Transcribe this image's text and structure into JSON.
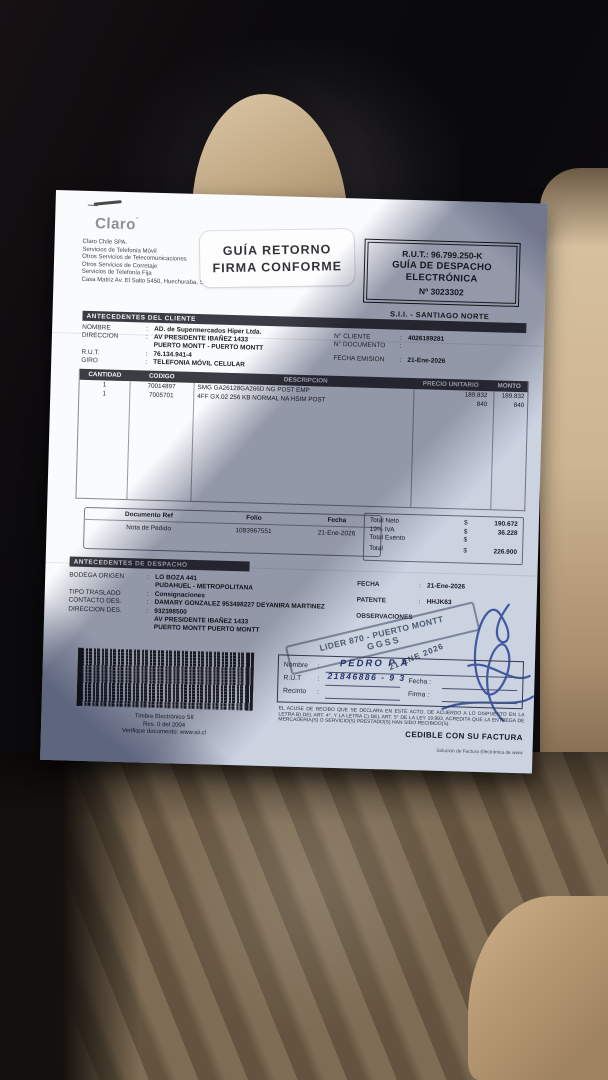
{
  "colors": {
    "section_bar": "#3c3c45",
    "stamp_ink": "#48546c",
    "pen_ink": "#2b3c7c",
    "paper": "#fafbfd"
  },
  "header": {
    "logo": "Claro",
    "company_lines": {
      "l0": "Claro Chile SPA.",
      "l1": "Servicios de Telefonía Móvil",
      "l2": "Otros Servicios de Telecomunicaciones",
      "l3": "Otros Servicios de Corretaje",
      "l4": "Servicios de Telefonía Fija",
      "l5": "Casa Matriz Av. El Salto 5450, Huechuraba, Sa"
    },
    "sticker": {
      "line1": "GUÍA RETORNO",
      "line2": "FIRMA CONFORME"
    },
    "rut_box": {
      "rut": "R.U.T.: 96.799.250-K",
      "doc_type_line1": "GUÍA DE DESPACHO",
      "doc_type_line2": "ELECTRÓNICA",
      "number": "Nº 3023302"
    },
    "sii_office": "S.I.I. - SANTIAGO NORTE"
  },
  "client": {
    "section_title": "ANTECEDENTES DEL CLIENTE",
    "fields": [
      {
        "label": "NOMBRE",
        "sep": ":",
        "value": "AD. de Supermercados Hiper Ltda."
      },
      {
        "label": "DIRECCION",
        "sep": ":",
        "value": "AV PRESIDENTE IBAÑEZ 1433"
      },
      {
        "label": "",
        "sep": "",
        "value": "PUERTO MONTT -  PUERTO MONTT"
      },
      {
        "label": "R.U.T.",
        "sep": ":",
        "value": "76.134.941-4"
      },
      {
        "label": "GIRO",
        "sep": ":",
        "value": "TELEFONIA MÓVIL CELULAR"
      }
    ],
    "right_fields": [
      {
        "label": "N° CLIENTE",
        "sep": ":",
        "value": "4026189281"
      },
      {
        "label": "N° DOCUMENTO",
        "sep": ":",
        "value": ""
      },
      {
        "label": "FECHA EMISION",
        "sep": ":",
        "value": "21-Ene-2026"
      }
    ]
  },
  "items": {
    "columns": [
      "CANTIDAD",
      "CODIGO",
      "DESCRIPCION",
      "PRECIO UNITARIO",
      "MONTO"
    ],
    "rows": [
      {
        "cantidad": "1",
        "codigo": "70014897",
        "descripcion": "SMG GA26128GA266D NG POST EMP",
        "precio": "189.832",
        "monto": "189.832"
      },
      {
        "cantidad": "1",
        "codigo": "7005701",
        "descripcion": "4FF GX.02 256 KB NORMAL NA HSIM POST",
        "precio": "840",
        "monto": "840"
      }
    ]
  },
  "ref_docs": {
    "columns": [
      "Documento Ref",
      "Folio",
      "Fecha"
    ],
    "row": {
      "doc": "Nota de Pedido",
      "folio": "1083967551",
      "fecha": "21-Ene-2026"
    }
  },
  "totals": {
    "rows": [
      {
        "label": "Total Neto",
        "currency": "$",
        "value": "190.672"
      },
      {
        "label": "19% IVA",
        "currency": "$",
        "value": "36.228"
      },
      {
        "label": "Total Exento",
        "currency": "$",
        "value": ""
      },
      {
        "label": "Total",
        "currency": "$",
        "value": "226.900"
      }
    ]
  },
  "dispatch": {
    "section_title": "ANTECEDENTES DE DESPACHO",
    "left_fields": [
      {
        "label": "BODEGA ORIGEN",
        "sep": ":",
        "value": "LO BOZA 441"
      },
      {
        "label": "",
        "sep": "",
        "value": "PUDAHUEL - METROPOLITANA"
      },
      {
        "label": "TIPO TRASLADO",
        "sep": ":",
        "value": "Consignaciones"
      },
      {
        "label": "CONTACTO DES.",
        "sep": ":",
        "value": "DAMARY GONZALEZ 953498227 DEYANIRA MARTINEZ"
      },
      {
        "label": "DIRECCION DES.",
        "sep": ":",
        "value": "932398500"
      },
      {
        "label": "",
        "sep": "",
        "value": "AV PRESIDENTE IBAÑEZ 1433"
      },
      {
        "label": "",
        "sep": "",
        "value": "PUERTO MONTT   PUERTO MONTT"
      }
    ],
    "right_fields": [
      {
        "label": "FECHA",
        "sep": ":",
        "value": "21-Ene-2026"
      },
      {
        "label": "PATENTE",
        "sep": ":",
        "value": "HHJK63"
      },
      {
        "label": "OBSERVACIONES",
        "sep": "",
        "value": ""
      }
    ]
  },
  "stamps": {
    "lider_line1": "LIDER 870 - PUERTO MONTT",
    "lider_line2": "GGSS",
    "date_stamp": "21 ENE 2026"
  },
  "receipt_box": {
    "name_label": "Nombre",
    "rut_label": "R.U.T",
    "recinto_label": "Recinto",
    "fecha_label": "Fecha :",
    "firma_label": "Firma :",
    "sep": ":",
    "handwritten_name": "PEDRO  P A",
    "handwritten_rut": "21846886 - 9 3",
    "legal_text": "EL ACUSE DE RECIBO QUE SE DECLARA EN ESTE ACTO, DE ACUERDO A LO DISPUESTO EN LA LETRA B) DEL ART. 4°, Y LA LETRA C) DEL ART. 5° DE LA LEY 19.983, ACREDITA QUE LA ENTREGA DE MERCADERIA(S) O SERVICIO(S) PRESTADO(S) HAN SIDO RECIBIDO(S).",
    "cedible": "CEDIBLE CON SU FACTURA"
  },
  "timbre": {
    "line1": "Timbre Electrónico SII",
    "line2": "Res. 0 del 2004",
    "line3": "Verifique documento: www.sii.cl"
  },
  "footer_provider": "Solución de Factura Electrónica de www"
}
